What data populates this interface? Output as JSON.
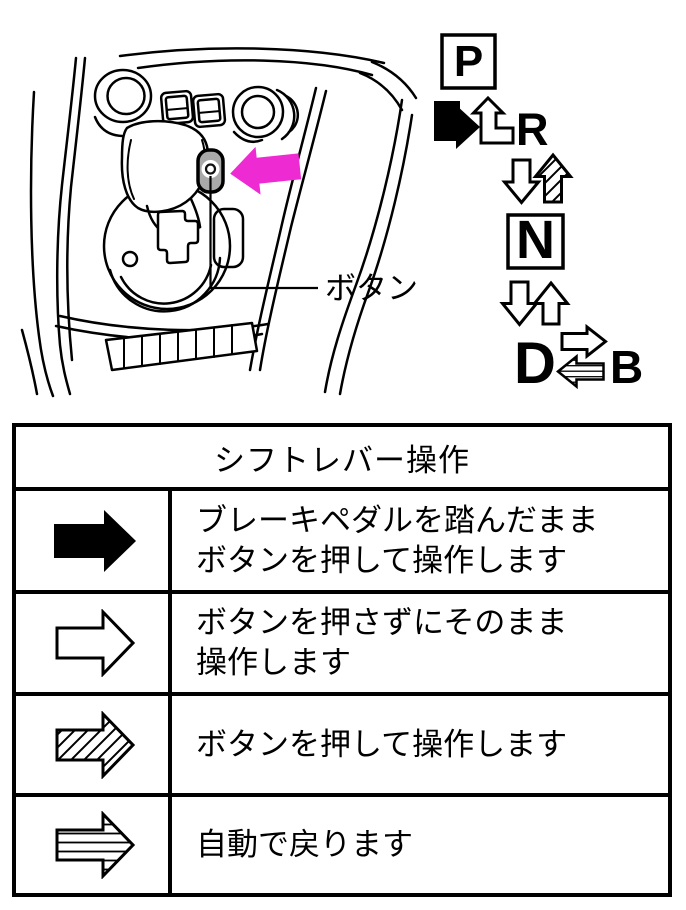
{
  "figure": {
    "button_label": "ボタン",
    "pointer_color": "#ee2bd2"
  },
  "shift_pattern": {
    "park": "P",
    "reverse": "R",
    "neutral": "N",
    "drive": "D",
    "engine_brake": "B",
    "arrows": {
      "p_to_r": "solid-black-bent",
      "r_to_p": "outline-up-bent",
      "r_to_n": "outline-down",
      "n_to_r": "diagonal-hatched-up",
      "n_to_d": "outline-down",
      "d_to_n": "outline-up",
      "d_to_b": "outline-right",
      "b_to_d": "horizontal-striped-left"
    }
  },
  "table": {
    "title": "シフトレバー操作",
    "rows": [
      {
        "arrow_style": "solid-black",
        "line1": "ブレーキペダルを踏んだまま",
        "line2": "ボタンを押して操作します"
      },
      {
        "arrow_style": "outline",
        "line1": "ボタンを押さずにそのまま",
        "line2": "操作します"
      },
      {
        "arrow_style": "diagonal-hatched",
        "line1": "ボタンを押して操作します",
        "line2": ""
      },
      {
        "arrow_style": "horizontal-striped",
        "line1": "自動で戻ります",
        "line2": ""
      }
    ]
  }
}
